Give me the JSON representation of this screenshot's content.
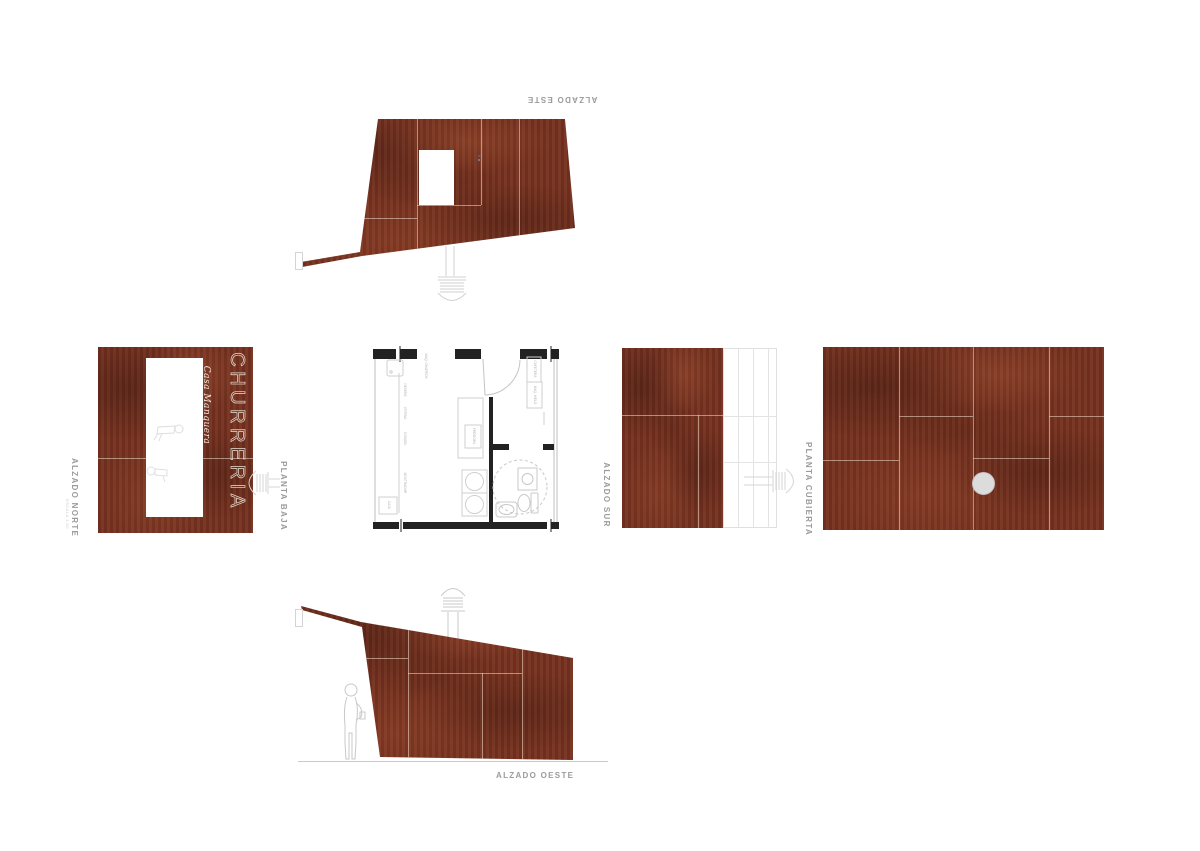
{
  "sheet": {
    "background": "#ffffff"
  },
  "palette": {
    "wood_base": "#73301f",
    "wood_dark": "#4f1f15",
    "wood_light": "#94452c",
    "joint_line": "#eedccc",
    "label_gray": "#9b9b9b",
    "drawing_line_gray": "#c9c9c9",
    "vent_gray": "#d2d2d2",
    "roof_vent_fill": "#dcdcdc"
  },
  "views": {
    "alzado_este": {
      "label": "ALZADO ESTE"
    },
    "alzado_norte": {
      "label": "ALZADO NORTE",
      "scale_note": "ESCALA 1:50",
      "sign_title": "CHURRERIA",
      "sign_subtitle": "Casa Manquera"
    },
    "planta_baja": {
      "label": "PLANTA BAJA",
      "equipment": [
        "MAQ. CHURROS",
        "NEVERA",
        "VITRINA",
        "CONGEL.",
        "MOSTRADOR",
        "FREIDORA",
        "CAJA",
        "CAFETERA",
        "MAQ. HIELO"
      ]
    },
    "alzado_sur": {
      "label": "ALZADO SUR"
    },
    "planta_cubierta": {
      "label": "PLANTA CUBIERTA"
    },
    "alzado_oeste": {
      "label": "ALZADO OESTE"
    }
  }
}
